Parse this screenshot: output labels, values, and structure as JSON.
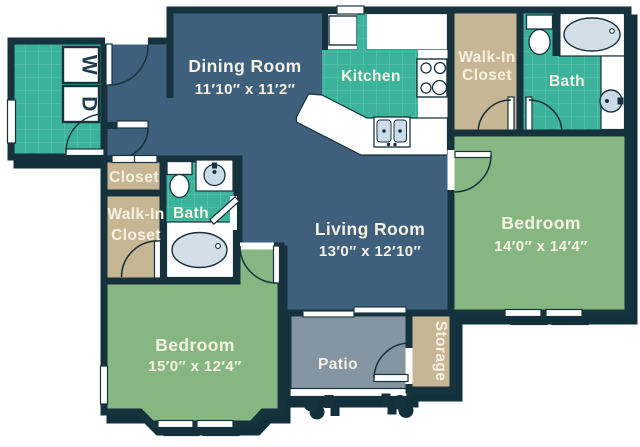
{
  "floorplan": {
    "rooms": {
      "dining": {
        "label": "Dining Room",
        "dims": "11′10″ x 11′2″"
      },
      "kitchen": {
        "label": "Kitchen"
      },
      "living": {
        "label": "Living Room",
        "dims": "13′0″ x 12′10″"
      },
      "bedroom_right": {
        "label": "Bedroom",
        "dims": "14′0″ x 14′4″"
      },
      "bedroom_left": {
        "label": "Bedroom",
        "dims": "15′0″ x 12′4″"
      },
      "walkin_right": {
        "line1": "Walk-In",
        "line2": "Closet"
      },
      "walkin_left": {
        "line1": "Walk-In",
        "line2": "Closet"
      },
      "closet": {
        "label": "Closet"
      },
      "bath_right": {
        "label": "Bath"
      },
      "bath_left": {
        "label": "Bath"
      },
      "patio": {
        "label": "Patio"
      },
      "storage": {
        "label": "Storage"
      }
    },
    "laundry": {
      "washer": "W",
      "dryer": "D"
    },
    "colors": {
      "wall": "#16323c",
      "floor_main": "#3f607c",
      "tile": "#3bb29a",
      "tile_grout": "#5fc3ae",
      "closet_tan": "#c7b694",
      "bedroom_green": "#86b782",
      "patio_gray": "#8595a2",
      "fixture_blue": "#ccdbe8",
      "label_cream": "#f4f0e2"
    }
  }
}
